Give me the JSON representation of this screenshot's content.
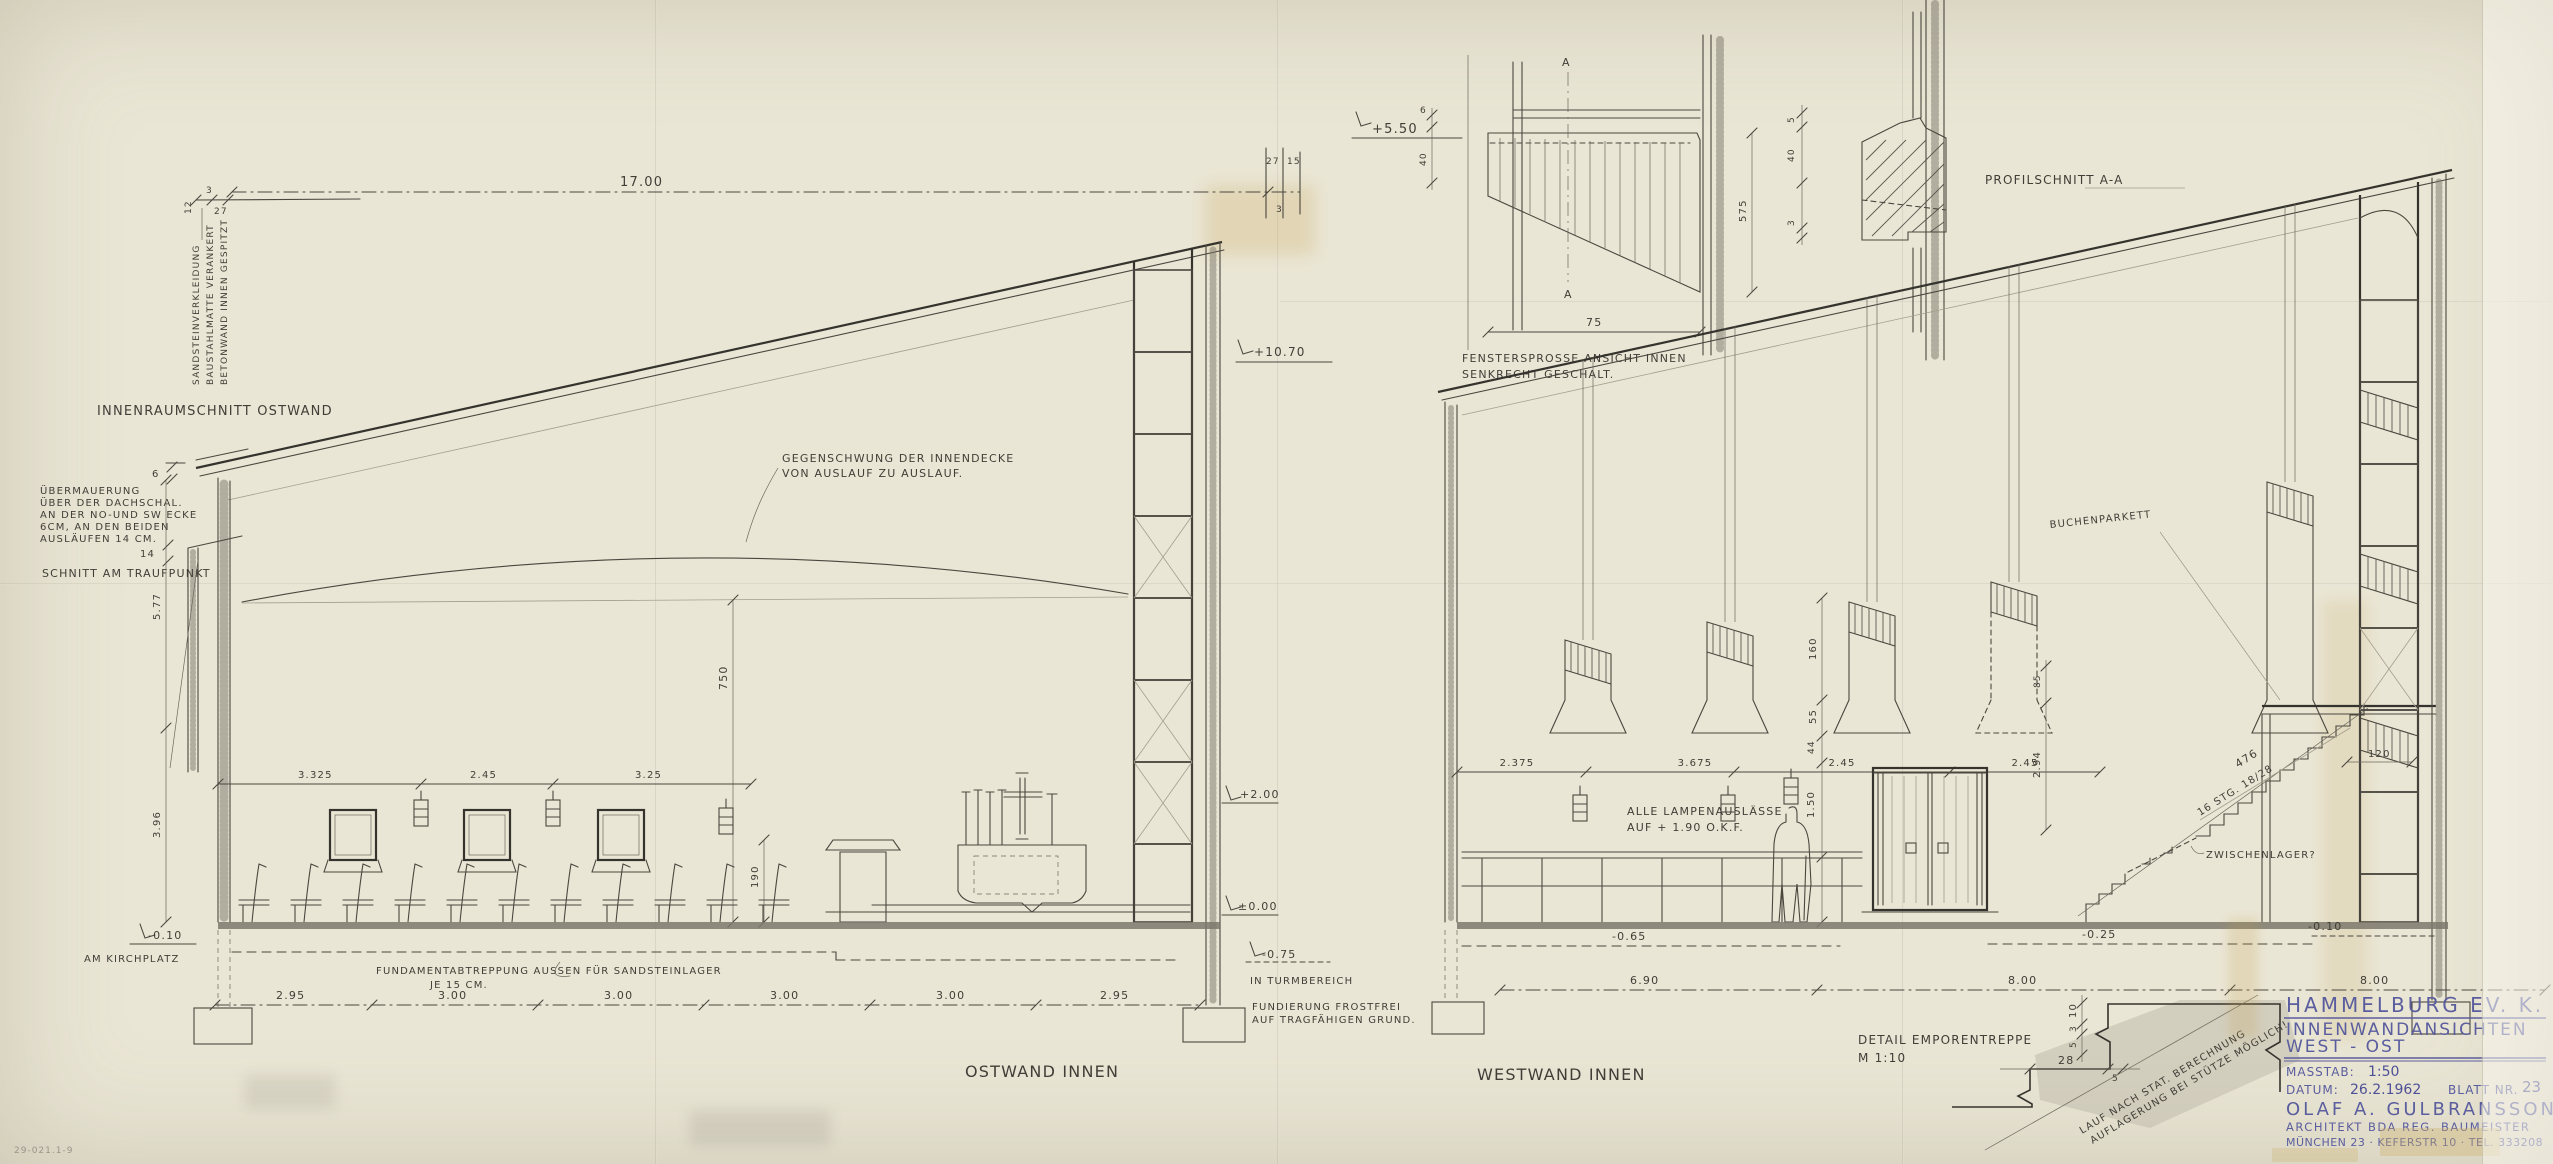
{
  "colors": {
    "paper": "#eae6d5",
    "ink": "#4a473f",
    "pencil": "#a49d8d",
    "titleblock_blue": "#5a5d9e"
  },
  "corner_note": {
    "lines": [
      "SANDSTEINVERKLEIDUNG",
      "BAUSTAHLMATTE VERANKERT",
      "BETONWAND INNEN GESPITZT"
    ],
    "dims": [
      "12",
      "3",
      "27"
    ]
  },
  "east": {
    "section_label": "INNENRAUMSCHNITT OSTWAND",
    "uebermauerung_lines": [
      "ÜBERMAUERUNG",
      "ÜBER DER DACHSCHAL.",
      "AN DER NO-UND SW ECKE",
      "6CM, AN DEN BEIDEN",
      "AUSLÄUFEN 14 CM."
    ],
    "dim_6": "6",
    "dim_14": "14",
    "traufpunkt_label": "SCHNITT AM TRAUFPUNKT",
    "top_dim": "17.00",
    "top_right_dims": [
      "27",
      "15",
      "3"
    ],
    "elev_top": "+10.70",
    "gegenschwung_lines": [
      "GEGENSCHWUNG DER INNENDECKE",
      "VON AUSLAUF ZU AUSLAUF."
    ],
    "left_dims": [
      "5.77",
      "3.96"
    ],
    "height_dim": "750",
    "lamp_height_dim": "190",
    "window_dims": [
      "3.325",
      "2.45",
      "3.25"
    ],
    "elev_kirchplatz": "-0.10",
    "kirchplatz_label": "AM KIRCHPLATZ",
    "elev_plus2": "+2.00",
    "elev_zero": "±0.00",
    "elev_turm": "-0.75",
    "turm_label": "IN TURMBEREICH",
    "fundament_lines": [
      "FUNDAMENTABTREPPUNG AUSSEN FÜR SANDSTEINLAGER",
      "JE 15 CM."
    ],
    "fundierung_lines": [
      "FUNDIERUNG FROSTFREI",
      "AUF TRAGFÄHIGEN GRUND."
    ],
    "bottom_dims": [
      "2.95",
      "3.00",
      "3.00",
      "3.00",
      "3.00",
      "2.95"
    ],
    "caption": "OSTWAND INNEN"
  },
  "sprosse": {
    "elev": "+5.50",
    "dim_a": "6",
    "dim_b": "40",
    "dim_width": "75",
    "dim_height": "575",
    "section_letter": "A",
    "caption_lines": [
      "FENSTERSPROSSE ANSICHT INNEN",
      "SENKRECHT GESCHALT."
    ],
    "side_dims": [
      "5",
      "40",
      "3"
    ]
  },
  "profil": {
    "caption": "PROFILSCHNITT A-A"
  },
  "west": {
    "caption": "WESTWAND INNEN",
    "lamp_note_lines": [
      "ALLE LAMPENAUSLÄSSE",
      "AUF + 1.90 O.K.F."
    ],
    "top_dims": [
      "2.375",
      "3.675",
      "2.45",
      "2.45"
    ],
    "dim_44": "44",
    "dim_150": "1.50",
    "dim_294": "2.94",
    "dim_85": "85",
    "dim_120": "120",
    "window_height_dims": [
      "160",
      "55"
    ],
    "stair_length_dim": "476",
    "stair_steps_note": "16 STG. 18/28",
    "zwischenlager_label": "ZWISCHENLAGER?",
    "parkett_label": "BUCHENPARKETT",
    "elev_minus065": "-0.65",
    "elev_minus025": "-0.25",
    "elev_minus010": "-0.10",
    "bottom_dims": [
      "6.90",
      "8.00",
      "8.00"
    ]
  },
  "stair_detail": {
    "caption_lines": [
      "DETAIL EMPORENTREPPE",
      "M 1:10"
    ],
    "dim_10": "10",
    "dim_3": "3",
    "dim_5a": "5",
    "dim_28": "28",
    "dim_5b": "5",
    "note_lines": [
      "LAUF NACH STAT. BERECHNUNG",
      "AUFLAGERUNG BEI STÜTZE MÖGLICH!"
    ]
  },
  "titleblock": {
    "project": "HAMMELBURG EV. K.",
    "subtitle1": "INNENWANDANSICHTEN",
    "subtitle2": "WEST - OST",
    "masstab_label": "MASSTAB:",
    "masstab": "1:50",
    "datum_label": "DATUM:",
    "datum": "26.2.1962",
    "blatt_label": "BLATT NR.",
    "blatt": "23",
    "architect": "OLAF A. GULBRANSSON",
    "architect_line2": "ARCHITEKT BDA REG. BAUMEISTER",
    "architect_line3": "MÜNCHEN 23 · KEFERSTR 10 · TEL. 333208"
  },
  "archive_no": "29-021.1-9"
}
